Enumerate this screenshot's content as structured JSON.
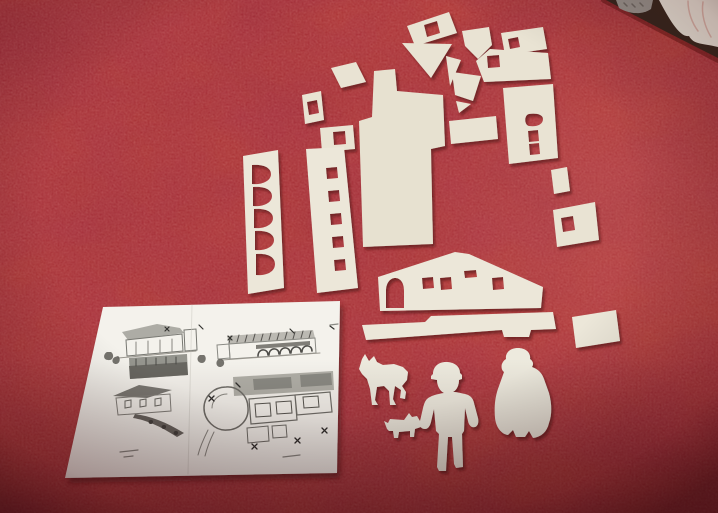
{
  "colors": {
    "table_red": "#b23a35",
    "table_blotch_dark": "#6b0d0f",
    "paper": "#e9e3d3",
    "paper_bright": "#ece7d9",
    "paper_main": "#e7e1d0",
    "figure_paper": "#edeade",
    "sheet_white": "#f4f2ec",
    "background_dark": "#37281f",
    "cloth_white": "#e8e4d9",
    "knit_grey": "#98948e",
    "shadow": "#4f0f0c"
  },
  "background": [
    {
      "n": "table-rim-shade",
      "d": "M604,0 C640,19 678,39 718,60",
      "s": "#5c1210",
      "w": 6,
      "o": 0.5
    },
    {
      "n": "room-dark-corner",
      "d": "M606,0 L718,0 L718,58 C676,37 639,18 606,0 Z",
      "f": "#37281f"
    },
    {
      "n": "knitted-item",
      "d": "M616,0 L653,0 L651,9 C641,16 627,13 619,8 Z",
      "f": "#98948e"
    },
    {
      "n": "knitted-item-texture",
      "d": "M624,3 L627,6 M632,4 L635,7 M640,3 L643,6",
      "s": "#6e6a64",
      "w": 1.5
    },
    {
      "n": "white-cloth",
      "d": "M659,0 L718,0 L718,47 C702,43 694,45 689,36 C680,38 669,19 659,0 Z",
      "f": "#e8e4d9"
    },
    {
      "n": "white-cloth-folds",
      "d": "M688,1 C688,12 692,23 698,31 M703,2 C701,14 705,27 711,37",
      "s": "#d3a99e",
      "w": 1.5,
      "o": 0.8
    }
  ],
  "sheet_base": [
    {
      "n": "plan-sheet-paper",
      "d": "M103,307 L340,301 L337,473 L65,478 Z",
      "f": "#f4f2ec"
    }
  ],
  "sheet_drawings": [
    {
      "n": "drawing-elevation1-roof",
      "d": "M122,332 L157,324 L180,328 L184,333 L128,340 Z",
      "f": "#8e8e88",
      "o": 0.7
    },
    {
      "n": "drawing-elevation1-wall",
      "d": "M126,340 L182,334 L183,351 L127,356 Z",
      "s": "#777771",
      "w": 1
    },
    {
      "n": "drawing-elevation1-posts",
      "d": "M136,342 L136,355 M148,341 L148,354 M160,340 L160,353 M172,339 L172,352",
      "s": "#88857f",
      "w": 1
    },
    {
      "n": "drawing-elevation1-base",
      "d": "M118,358 L196,351",
      "s": "#9a978f",
      "w": 1
    },
    {
      "n": "drawing-elevation1-tower",
      "d": "M184,330 L196,329 L197,350 L185,351 Z",
      "s": "#777771",
      "w": 1
    },
    {
      "n": "drawing-trees-left",
      "d": "M107,352 C103,354 103,360 108,360 C113,361 115,355 111,352 Z M115,357 C111,359 112,364 116,364 C120,364 121,358 118,356 Z",
      "f": "#55524e",
      "o": 0.8
    },
    {
      "n": "drawing-arrow-marks1",
      "d": "M165,327 L169,331 M169,327 L165,331 M199,325 L203,329",
      "s": "#333330",
      "w": 1.2
    },
    {
      "n": "drawing-long-band",
      "d": "M129,358 L187,354 L188,375 L130,379 Z",
      "f": "#8f8f89",
      "o": 0.95
    },
    {
      "n": "drawing-long-band-dark",
      "d": "M129,366 L187,362 L188,375 L130,379 Z",
      "f": "#63625c",
      "o": 0.9
    },
    {
      "n": "drawing-long-band-ticks",
      "d": "M136,359 L136,366 M146,358 L146,365 M156,358 L156,365 M166,357 L166,364 M176,357 L176,364",
      "s": "#4a4a46",
      "w": 1
    },
    {
      "n": "drawing-elevation2-roofband",
      "d": "M227,336 L313,330 L315,338 L229,344 Z",
      "f": "#b5b3ac",
      "o": 0.9
    },
    {
      "n": "drawing-elevation2-hatch",
      "d": "M231,336 L229,343 M239,335 L237,342 M247,335 L245,342 M255,334 L253,341 M263,334 L261,341 M271,333 L269,340 M279,333 L277,340 M287,332 L285,339 M295,332 L293,339 M303,331 L301,338 M311,331 L309,338",
      "s": "#55534f",
      "w": 1
    },
    {
      "n": "drawing-elevation2-wall",
      "d": "M229,344 L315,338 L316,353 L230,359 Z",
      "s": "#8a8a84",
      "w": 1
    },
    {
      "n": "drawing-elevation2-arcade-band",
      "d": "M256,345 L310,341 L310,345 L256,349 Z",
      "f": "#6b6a64",
      "o": 0.85
    },
    {
      "n": "drawing-elevation2-arches",
      "d": "M258,356 C258,348 268,348 268,355 M269,355 C269,347 279,347 279,354 M280,354 C280,346 290,346 290,353 M291,353 C291,345 301,345 301,352 M302,352 C302,344 312,344 312,351",
      "s": "#4e4d49",
      "w": 1.6
    },
    {
      "n": "drawing-elevation2-base",
      "d": "M222,360 L320,353",
      "s": "#9a978f",
      "w": 1
    },
    {
      "n": "drawing-elevation2-left-wing",
      "d": "M217,345 L229,344 L230,358 L218,359 Z",
      "s": "#8a8a84",
      "w": 1
    },
    {
      "n": "drawing-arrow-marks2",
      "d": "M228,336 L232,340 M232,336 L228,340 M290,329 L294,333 M330,326 L334,329",
      "s": "#333330",
      "w": 1.2
    },
    {
      "n": "drawing-trees-middle",
      "d": "M200,355 C196,357 197,363 202,363 C206,363 207,357 204,355 Z M219,359 C215,361 216,367 220,367 C224,367 226,362 222,359 Z",
      "f": "#55524e",
      "o": 0.8
    },
    {
      "n": "drawing-elevation3-roof",
      "d": "M113,396 L139,385 L172,390 L147,398 Z",
      "f": "#6e6c66",
      "o": 0.9
    },
    {
      "n": "drawing-elevation3-wall",
      "d": "M116,398 L170,394 L171,411 L118,415 Z",
      "s": "#82807a",
      "w": 1
    },
    {
      "n": "drawing-elevation3-windows",
      "d": "M125,401 L131,400 L131,407 L125,408 Z M140,400 L146,399 L146,406 L140,407 Z M155,399 L161,398 L161,405 L155,406 Z",
      "s": "#6b6a64",
      "w": 1
    },
    {
      "n": "drawing-hill-scribble",
      "d": "M135,414 C150,416 166,422 184,433 L177,437 C160,426 146,420 133,418 Z",
      "f": "#5a5751",
      "o": 0.9
    },
    {
      "n": "drawing-hill-shrubs",
      "d": "M150,420 C148,421 148,424 151,424 C153,424 154,421 152,420 Z M163,425 C161,426 161,429 164,429 C166,429 167,426 165,425 Z M175,431 C173,432 173,435 176,435 C178,435 179,432 177,431 Z",
      "f": "#44423e"
    },
    {
      "n": "drawing-siteplan-topband",
      "d": "M233,377 L333,371 L334,390 L234,396 Z",
      "f": "#a8a7a0",
      "o": 0.9
    },
    {
      "n": "drawing-siteplan-topband-dark",
      "d": "M253,379 L291,377 L292,388 L254,390 Z M300,375 L331,373 L332,385 L301,387 Z",
      "f": "#7b7a73",
      "o": 0.7
    },
    {
      "n": "drawing-siteplan-circle",
      "d": "M204,408 C204,396 214,387 226,387 C238,386 248,396 248,408 C249,420 239,430 227,430 C215,431 204,420 204,408 Z",
      "s": "#706f69",
      "w": 1.5
    },
    {
      "n": "drawing-siteplan-circle-inner",
      "d": "M212,408 C212,400 219,394 227,394",
      "s": "#8b8a83",
      "w": 1
    },
    {
      "n": "drawing-siteplan-rooms",
      "d": "M249,399 L295,395 L297,420 L251,424 Z M295,395 L330,392 L332,412 L297,415 Z",
      "s": "#6f6e68",
      "w": 1.2
    },
    {
      "n": "drawing-siteplan-rooms-inner",
      "d": "M255,404 L270,403 L271,416 L256,417 Z M276,402 L291,401 L292,413 L277,414 Z M303,397 L318,396 L319,407 L304,408 Z",
      "s": "#56554f",
      "w": 1
    },
    {
      "n": "drawing-siteplan-lower-rooms",
      "d": "M247,428 L268,426 L269,441 L248,443 Z M272,426 L286,425 L287,437 L273,438 Z",
      "s": "#6f6e68",
      "w": 1
    },
    {
      "n": "drawing-siteplan-paths",
      "d": "M208,430 C204,438 200,447 198,455 M214,432 C210,440 207,448 205,456",
      "s": "#8b8a83",
      "w": 1
    },
    {
      "n": "drawing-arrow-marks3",
      "d": "M209,396 L214,401 M214,396 L209,401 M252,444 L257,449 M257,444 L252,449 M295,438 L300,443 M300,438 L295,443 M322,428 L327,433 M327,428 L322,433 M236,383 L240,387",
      "s": "#2f2e2c",
      "w": 1.3
    },
    {
      "n": "drawing-caption-dashes",
      "d": "M120,452 L138,450 M124,457 L133,456 M283,457 L300,455 M330,325 L338,324",
      "s": "#8a8a84",
      "w": 1.2
    },
    {
      "n": "sheet-crease",
      "d": "M192,305 L188,474",
      "s": "#c9c7c0",
      "w": 1,
      "o": 0.5
    }
  ],
  "cutouts": [
    {
      "n": "cutout-rect-window-top",
      "d": "M407,26 L449,12 L457,33 L415,46 Z M424,25 L437,21 L440,33 L427,37 Z",
      "fr": "evenodd"
    },
    {
      "n": "cutout-triangle-large",
      "d": "M402,43 L452,44 L431,78 Z"
    },
    {
      "n": "cutout-triangle-narrow",
      "d": "M446,56 L461,60 L450,86 Z"
    },
    {
      "n": "cutout-pennant",
      "d": "M462,31 L489,27 L492,45 L478,59 L465,46 Z"
    },
    {
      "n": "cutout-quad-small",
      "d": "M452,72 L481,76 L473,101 L455,95 Z"
    },
    {
      "n": "cutout-triangle-tiny",
      "d": "M456,101 L471,104 L459,113 Z"
    },
    {
      "n": "cutout-rect-window-topright",
      "d": "M501,33 L543,27 L547,49 L505,55 Z M508,39 L518,37 L520,47 L510,49 Z",
      "fr": "evenodd"
    },
    {
      "n": "cutout-roof-panel",
      "d": "M476,61 L490,49 L548,53 L551,79 L484,82 Z M487,56 L499,55 L500,67 L488,68 Z",
      "fr": "evenodd"
    },
    {
      "n": "cutout-wall-panel-right",
      "d": "M503,88 L553,84 L558,158 L509,164 Z M529,114 C524,115 524,125 529,126 C536,127 543,125 543,119 C543,114 535,113 529,114 Z M528,131 L538,130 L539,141 L529,142 Z M529,144 L539,143 L540,154 L530,155 Z",
      "fr": "evenodd"
    },
    {
      "n": "cutout-rect-small-center",
      "d": "M449,121 L496,116 L498,139 L451,144 Z"
    },
    {
      "n": "cutout-chip-right",
      "d": "M551,170 L567,167 L570,191 L554,194 Z"
    },
    {
      "n": "cutout-panel-window-right",
      "d": "M553,210 L595,202 L599,240 L557,247 Z M561,218 L573,216 L575,230 L563,232 Z",
      "fr": "evenodd"
    },
    {
      "n": "cutout-rect-window-left",
      "d": "M302,95 L321,91 L324,120 L305,124 Z M307,102 L317,100 L319,113 L309,115 Z",
      "fr": "evenodd"
    },
    {
      "n": "cutout-quad-center",
      "d": "M331,68 L356,62 L366,82 L341,88 Z"
    },
    {
      "n": "cutout-trapezoid-window",
      "d": "M320,128 L353,125 L355,149 L322,152 Z M333,132 L345,131 L346,144 L334,145 Z",
      "fr": "evenodd"
    },
    {
      "n": "cutout-strip-square-windows",
      "d": "M306,149 L344,147 L358,288 L317,293 Z M326,168 L337,167 L338,178 L327,179 Z M328,191 L339,190 L340,201 L329,202 Z M330,214 L341,213 L342,224 L331,225 Z M332,237 L343,236 L344,247 L333,248 Z M334,260 L345,259 L346,270 L335,271 Z",
      "fr": "evenodd",
      "f": "#ece7d9"
    },
    {
      "n": "cutout-strip-arch-windows",
      "d": "M243,156 L278,150 L284,288 L248,294 Z M252,165 L252,184 C262,185 271,181 271,174 C271,167 262,164 252,165 Z M253,187 L253,206 C263,207 272,203 272,196 C272,189 263,186 253,187 Z M254,209 L254,228 C264,229 273,225 273,218 C273,211 264,208 254,209 Z M255,231 L255,250 C265,251 274,247 274,240 C274,233 265,230 255,231 Z M256,254 L256,275 C266,276 275,272 275,264 C275,256 266,253 256,254 Z",
      "fr": "evenodd",
      "f": "#ece7d9"
    },
    {
      "n": "cutout-main-building-wall",
      "d": "M374,71 L395,69 L397,91 L443,95 L445,146 L431,149 L433,244 L363,247 L359,121 L372,117 Z",
      "f": "#e7e1d0"
    },
    {
      "n": "cutout-house-facade",
      "d": "M380,311 L378,277 L455,252 L469,254 L543,287 L541,308 Z M386,308 L386,291 C386,282 391,278 395,278 C400,278 404,282 404,291 L404,308 Z M422,278 L433,277 L434,288 L423,289 Z M440,278 L451,277 L452,289 L441,290 Z M464,271 L476,270 L477,277 L465,278 Z M492,278 L503,277 L504,289 L493,290 Z",
      "fr": "evenodd",
      "f": "#ece7d9"
    },
    {
      "n": "cutout-base-strip",
      "d": "M362,325 L425,322 L431,316 L553,312 L556,329 L531,330 L529,337 L504,337 L502,330 L366,340 Z",
      "f": "#ece7d9"
    },
    {
      "n": "cutout-base-strip-right",
      "d": "M572,317 L616,310 L620,341 L576,348 Z",
      "f": "#ece7d9"
    },
    {
      "n": "cutout-dog-figure",
      "d": "M359,369 L362,359 L365,354 L369,361 L374,356 L377,362 L383,365 L394,364 L403,367 L408,372 L407,380 L402,386 L406,392 L405,399 L400,398 L401,390 L395,386 L393,399 L396,405 L390,405 L389,391 L384,386 L377,387 L375,400 L378,405 L372,405 L370,389 L367,379 L362,374 Z",
      "f": "#edeade"
    },
    {
      "n": "cutout-small-dog-figure",
      "d": "M387,429 L384,421 L388,423 L390,419 L404,420 L409,413 L412,417 L417,416 L420,421 L421,427 L415,429 L414,437 L410,437 L410,431 L399,432 L398,438 L394,438 L393,431 L389,431 Z",
      "f": "#edeade"
    },
    {
      "n": "cutout-man-figure",
      "d": "M446,362 C438,362 433,367 433,374 L431,376 L431,379 L437,380 C437,386 440,391 444,393 C437,394 430,396 427,399 C425,401 424,404 423,408 L420,421 C419,426 421,429 425,429 C428,429 430,426 431,422 L434,409 L436,431 L439,434 L437,467 L439,471 L446,471 L448,437 L452,437 L454,464 L456,468 L463,467 L462,434 L464,431 L465,408 L468,421 C469,426 472,428 475,427 C478,426 479,422 478,418 L474,403 C473,398 470,395 465,394 C460,393 457,392 453,392 C457,390 459,385 459,380 L462,379 L462,375 L460,373 C460,366 454,362 446,362 Z",
      "f": "#edeade"
    },
    {
      "n": "cutout-woman-figure",
      "d": "M506,359 C505,352 511,348 518,348 C526,348 531,353 530,359 C533,361 534,364 532,367 C538,369 542,373 544,379 L549,393 C552,404 552,415 549,423 C547,432 541,437 533,438 L529,431 L525,437 L516,437 L513,430 L508,435 C501,434 496,427 495,418 C494,407 495,396 499,386 L504,372 C500,369 501,362 506,359 Z",
      "f": "#edeade"
    }
  ]
}
